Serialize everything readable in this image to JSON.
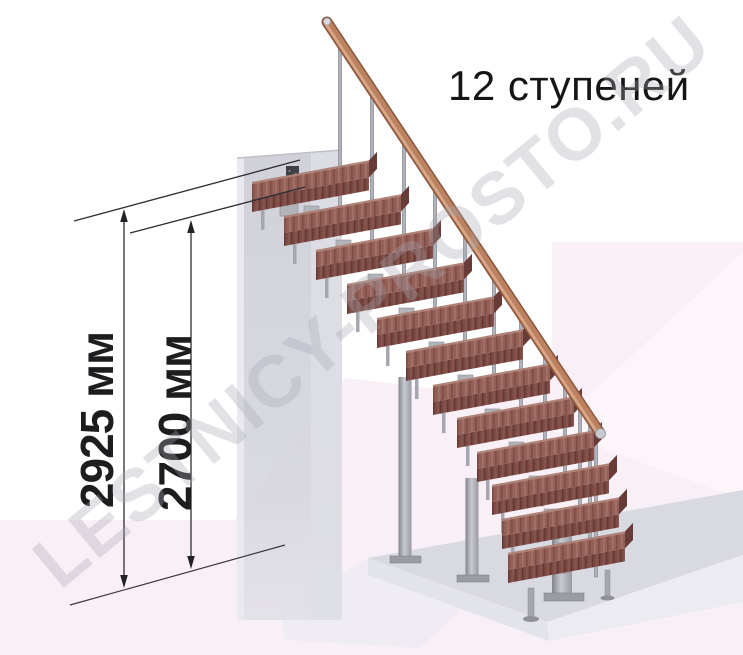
{
  "title": "12 ступеней",
  "watermark": "LESTNICY-PROSTO.RU",
  "dimensions": [
    {
      "label": "2925 мм",
      "value_mm": 2925
    },
    {
      "label": "2700 мм",
      "value_mm": 2700
    }
  ],
  "stairs": {
    "step_count": 12,
    "steps": [
      {
        "x": 252,
        "y": 212
      },
      {
        "x": 284,
        "y": 246
      },
      {
        "x": 316,
        "y": 280
      },
      {
        "x": 347,
        "y": 314
      },
      {
        "x": 377,
        "y": 348
      },
      {
        "x": 406,
        "y": 381
      },
      {
        "x": 433,
        "y": 415
      },
      {
        "x": 457,
        "y": 448
      },
      {
        "x": 477,
        "y": 482
      },
      {
        "x": 492,
        "y": 515
      },
      {
        "x": 502,
        "y": 549
      },
      {
        "x": 508,
        "y": 583
      }
    ],
    "balusters": [
      {
        "x": 340,
        "top": 46,
        "h": 160
      },
      {
        "x": 372,
        "top": 94,
        "h": 146
      },
      {
        "x": 404,
        "top": 142,
        "h": 132
      },
      {
        "x": 435,
        "top": 189,
        "h": 119
      },
      {
        "x": 465,
        "top": 234,
        "h": 108
      },
      {
        "x": 494,
        "top": 278,
        "h": 97
      },
      {
        "x": 521,
        "top": 318,
        "h": 91
      },
      {
        "x": 545,
        "top": 354,
        "h": 88
      },
      {
        "x": 565,
        "top": 385,
        "h": 91
      },
      {
        "x": 580,
        "top": 407,
        "h": 102
      },
      {
        "x": 590,
        "top": 422,
        "h": 121
      },
      {
        "x": 596,
        "top": 431,
        "h": 146
      }
    ],
    "modules": [
      {
        "x": 304,
        "y": 206
      },
      {
        "x": 336,
        "y": 240
      },
      {
        "x": 368,
        "y": 274
      },
      {
        "x": 399,
        "y": 308
      },
      {
        "x": 429,
        "y": 342
      },
      {
        "x": 458,
        "y": 375
      },
      {
        "x": 485,
        "y": 409
      },
      {
        "x": 509,
        "y": 442
      },
      {
        "x": 529,
        "y": 476
      },
      {
        "x": 544,
        "y": 509
      },
      {
        "x": 554,
        "y": 543
      }
    ],
    "legs": [
      {
        "x": 261,
        "y": 210
      },
      {
        "x": 293,
        "y": 244
      },
      {
        "x": 325,
        "y": 278
      },
      {
        "x": 356,
        "y": 312
      },
      {
        "x": 386,
        "y": 346
      },
      {
        "x": 415,
        "y": 379
      },
      {
        "x": 442,
        "y": 413
      },
      {
        "x": 466,
        "y": 446
      },
      {
        "x": 486,
        "y": 480
      },
      {
        "x": 501,
        "y": 513
      },
      {
        "x": 511,
        "y": 547
      }
    ]
  },
  "colors": {
    "wood_top": "#935f57",
    "wood_front": "#7d4a43",
    "wood_side": "#693b36",
    "wood_highlight": "#b4897c",
    "rail_main": "#bc8260",
    "rail_dark": "#8a5640",
    "rail_light": "#dcae8d",
    "metal": "#b2b2ba",
    "metal_module": "#b3b3ba",
    "metal_leg": "#a6a6ae",
    "wall": "#d3d3db",
    "platform_top": "#d9d9e2",
    "platform_front": "#ecebf1",
    "background_pink": "#f9eff6",
    "dimension": "#2e2e32",
    "text": "#151515"
  }
}
